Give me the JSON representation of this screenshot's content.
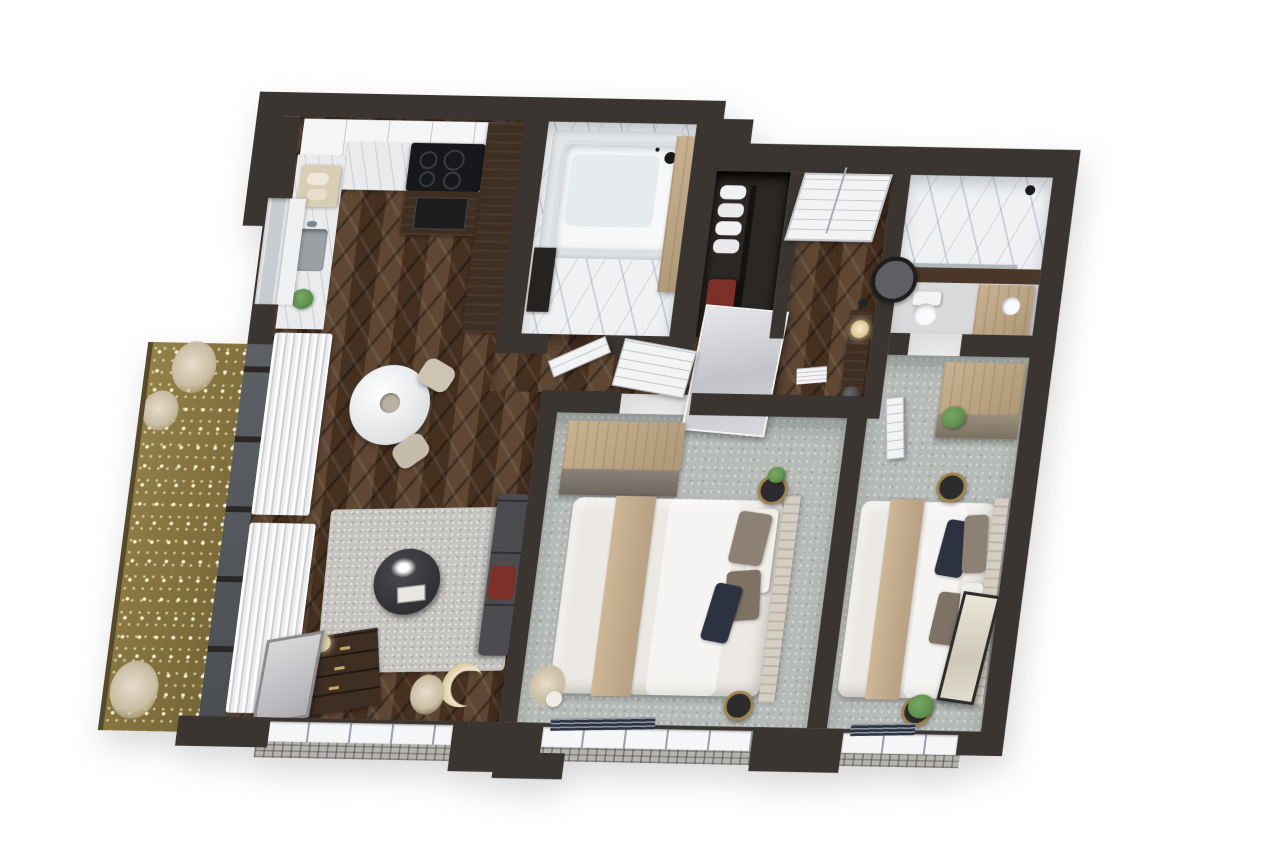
{
  "scene": {
    "type": "3d-floor-plan-render",
    "view": "axonometric-top-down",
    "background": "#ffffff",
    "apartment": "two-bedroom apartment with balcony"
  },
  "palette": {
    "wall": "#3a3531",
    "wall_inner": "#d7d7da",
    "wood_floor_dark": "#4a3322",
    "wood_floor_light": "#5f4734",
    "carpet": "#b7bbb8",
    "marble": "#eff1f3",
    "tile_gray": "#d9dadc",
    "balcony_floor": "#8a7840",
    "cabinet_dark": "#3f2e22",
    "cabinet_white": "#f4f5f7",
    "counter_marble": "#e9ebed",
    "wood_tan": "#c9b291",
    "bed_linen": "#ece9e4",
    "bed_runner": "#c4ae8e",
    "pillow_taupe": "#8c8174",
    "pillow_navy": "#2c3240",
    "sofa": "#4b4b50",
    "accent_red": "#7c3028",
    "rug": "#c6c4c1",
    "plant_green": "#5f8f4f",
    "steel": "#9aa0a4",
    "glass": "#565a5e",
    "door_white": "#f2f3f5",
    "rattan": "#a0854f",
    "black_decor": "#2c2c2e",
    "cooktop_black": "#17181b",
    "headboard": "#d6cec2"
  },
  "rooms": [
    {
      "name": "kitchen",
      "floor": "dark-herringbone-wood",
      "furniture": [
        "white-upper-cabinets",
        "marble-counter",
        "steel-sink",
        "cutting-board",
        "cooktop",
        "oven",
        "tall-dark-cabinet",
        "herb-plant"
      ]
    },
    {
      "name": "living-room",
      "floor": "dark-herringbone-wood",
      "furniture": [
        "round-dining-table",
        "dining-chairs",
        "gray-rug",
        "round-coffee-table",
        "charcoal-sofa",
        "red-throw",
        "wood-dresser",
        "leaning-mirror",
        "table-lamp",
        "crescent-moon-decor",
        "pampas-grass",
        "sheer-curtains"
      ]
    },
    {
      "name": "bathroom-1",
      "floor": "white-marble",
      "furniture": [
        "bathtub",
        "shower-head",
        "wood-vanity-panel",
        "dark-sink-unit",
        "open-door"
      ]
    },
    {
      "name": "storage-closet",
      "floor": "dark",
      "furniture": [
        "towel-shelves",
        "red-appliance",
        "leaning-mirror-panel"
      ]
    },
    {
      "name": "hallway",
      "floor": "dark-herringbone-wood",
      "furniture": [
        "entry-double-door",
        "console-table",
        "table-lamp",
        "round-wall-mirror",
        "decor-bowl",
        "book-stack"
      ]
    },
    {
      "name": "bathroom-2",
      "floor": "marble-and-gray-tile",
      "furniture": [
        "marble-shower",
        "glass-screen",
        "toilet",
        "wood-vanity",
        "dark-wood-panel"
      ]
    },
    {
      "name": "bedroom-1",
      "floor": "gray-carpet",
      "furniture": [
        "wardrobe",
        "double-bed",
        "beige-runner",
        "taupe-pillows",
        "navy-pillow",
        "wood-headboard",
        "rattan-side-tables",
        "potted-plant",
        "pampas-grass",
        "window-blinds"
      ]
    },
    {
      "name": "bedroom-2",
      "floor": "gray-carpet",
      "furniture": [
        "dresser-wardrobe",
        "double-bed",
        "beige-runner",
        "taupe-pillows",
        "navy-pillow",
        "wood-headboard",
        "rattan-side-tables",
        "leaning-floor-mirror",
        "potted-plants"
      ]
    },
    {
      "name": "balcony",
      "floor": "gold-olive-deck",
      "furniture": [
        "string-lights",
        "pampas-plants"
      ]
    }
  ],
  "exterior": {
    "walls": "dark charcoal cut walls",
    "windows": [
      "living-room-window",
      "bedroom-1-window",
      "bedroom-2-window",
      "kitchen-window",
      "balcony-glass-doors"
    ],
    "sills": "light brick sills outside bottom windows"
  }
}
